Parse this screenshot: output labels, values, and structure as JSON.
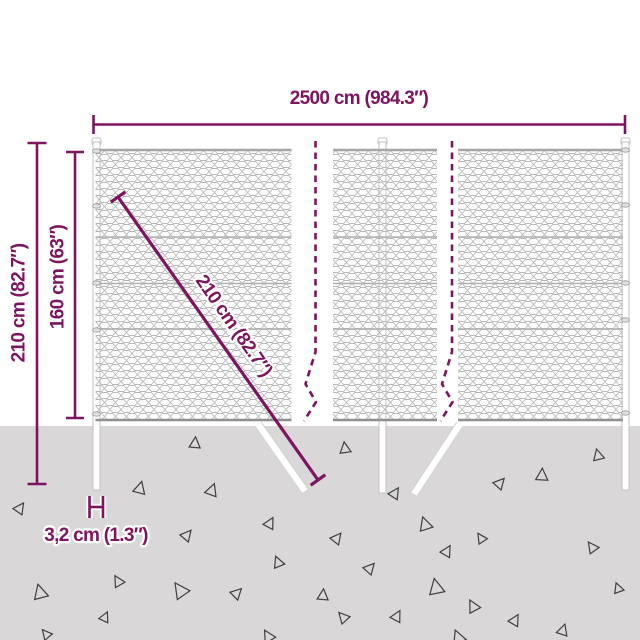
{
  "diagram": {
    "type": "product-dimension-diagram",
    "subject": "chain-link fence with posts set into ground",
    "labels": {
      "width": "2500 cm (984.3″)",
      "total_height": "210 cm (82.7″)",
      "mesh_height": "160 cm (63″)",
      "diagonal": "210 cm (82.7″)",
      "post_diameter": "3,2 cm (1.3″)"
    },
    "colors": {
      "dimension_accent": "#7d1460",
      "ground": "#d9d7d7",
      "mesh_wire": "#b8b8b8",
      "triangle_outline": "#3f3f3f"
    },
    "ground": {
      "triangles": [
        {
          "x": 20,
          "y": 508,
          "s": 10,
          "r": 35
        },
        {
          "x": 40,
          "y": 592,
          "s": 13,
          "r": -15
        },
        {
          "x": 46,
          "y": 634,
          "s": 9,
          "r": -40
        },
        {
          "x": 105,
          "y": 617,
          "s": 9,
          "r": 25
        },
        {
          "x": 118,
          "y": 581,
          "s": 10,
          "r": -30
        },
        {
          "x": 140,
          "y": 488,
          "s": 11,
          "r": 15
        },
        {
          "x": 180,
          "y": 590,
          "s": 14,
          "r": -35
        },
        {
          "x": 187,
          "y": 535,
          "s": 10,
          "r": 40
        },
        {
          "x": 195,
          "y": 443,
          "s": 10,
          "r": 5
        },
        {
          "x": 212,
          "y": 490,
          "s": 11,
          "r": 20
        },
        {
          "x": 237,
          "y": 593,
          "s": 10,
          "r": 45
        },
        {
          "x": 268,
          "y": 636,
          "s": 11,
          "r": -30
        },
        {
          "x": 270,
          "y": 523,
          "s": 10,
          "r": 28
        },
        {
          "x": 278,
          "y": 562,
          "s": 10,
          "r": -22
        },
        {
          "x": 323,
          "y": 595,
          "s": 10,
          "r": 5
        },
        {
          "x": 337,
          "y": 538,
          "s": 10,
          "r": 38
        },
        {
          "x": 343,
          "y": 617,
          "s": 10,
          "r": -42
        },
        {
          "x": 345,
          "y": 448,
          "s": 10,
          "r": -8
        },
        {
          "x": 370,
          "y": 568,
          "s": 10,
          "r": 42
        },
        {
          "x": 395,
          "y": 493,
          "s": 10,
          "r": 33
        },
        {
          "x": 397,
          "y": 616,
          "s": 10,
          "r": 28
        },
        {
          "x": 425,
          "y": 524,
          "s": 12,
          "r": -18
        },
        {
          "x": 436,
          "y": 587,
          "s": 14,
          "r": -12
        },
        {
          "x": 447,
          "y": 551,
          "s": 10,
          "r": 30
        },
        {
          "x": 458,
          "y": 637,
          "s": 12,
          "r": -22
        },
        {
          "x": 473,
          "y": 606,
          "s": 11,
          "r": -28
        },
        {
          "x": 481,
          "y": 538,
          "s": 9,
          "r": -33
        },
        {
          "x": 500,
          "y": 483,
          "s": 10,
          "r": 42
        },
        {
          "x": 515,
          "y": 620,
          "s": 10,
          "r": 30
        },
        {
          "x": 542,
          "y": 475,
          "s": 11,
          "r": 3
        },
        {
          "x": 563,
          "y": 630,
          "s": 10,
          "r": 18
        },
        {
          "x": 592,
          "y": 547,
          "s": 10,
          "r": -36
        },
        {
          "x": 598,
          "y": 455,
          "s": 10,
          "r": -14
        },
        {
          "x": 618,
          "y": 588,
          "s": 9,
          "r": -20
        }
      ]
    }
  }
}
